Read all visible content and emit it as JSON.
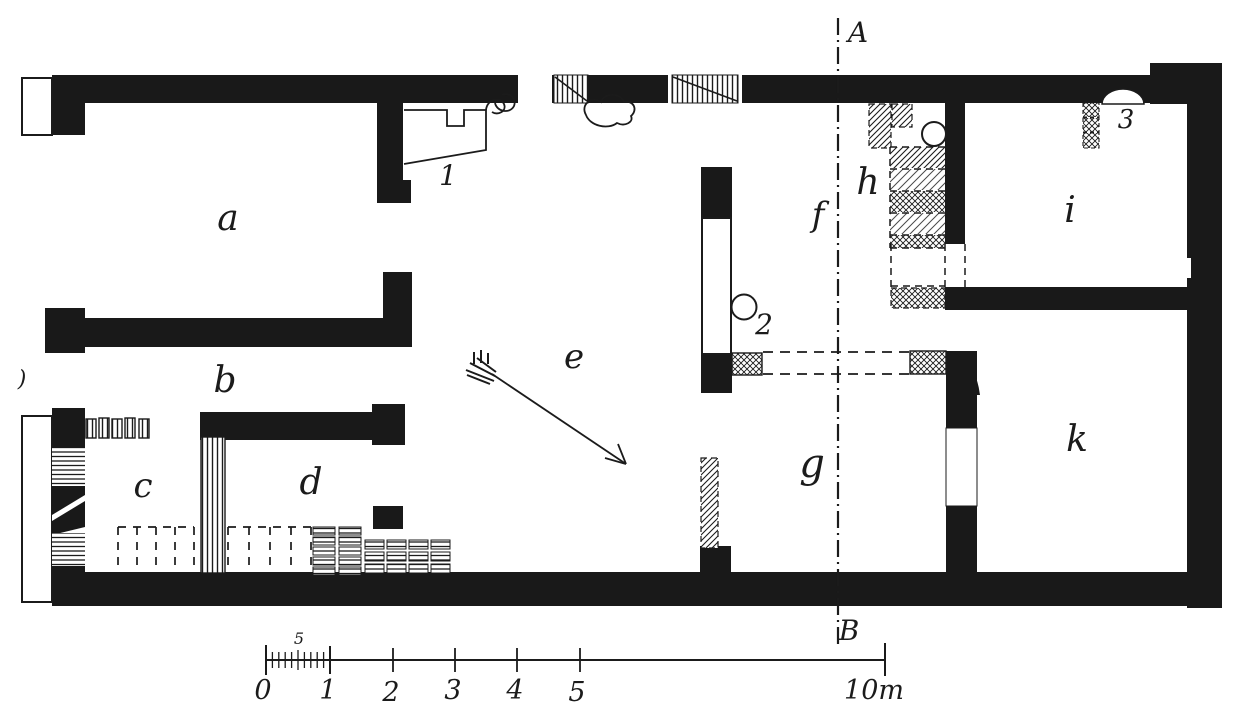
{
  "figure": {
    "type": "archaeological floor plan engraving",
    "room_labels": {
      "a": "a",
      "b": "b",
      "c": "c",
      "d": "d",
      "e": "e",
      "f": "f",
      "g": "g",
      "h": "h",
      "i": "i",
      "k": "k"
    },
    "feature_numbers": {
      "n1": "1",
      "n2": "2",
      "n3": "3"
    },
    "section_line": {
      "top_label": "A",
      "bottom_label": "B"
    },
    "scale_bar": {
      "tick_labels": [
        "0",
        "1",
        "2",
        "3",
        "4",
        "5"
      ],
      "end_label": "10m",
      "subdivision_label": "5"
    },
    "stray_mark": ")"
  },
  "colors": {
    "ink": "#1b1b1b",
    "paper": "#ffffff"
  }
}
